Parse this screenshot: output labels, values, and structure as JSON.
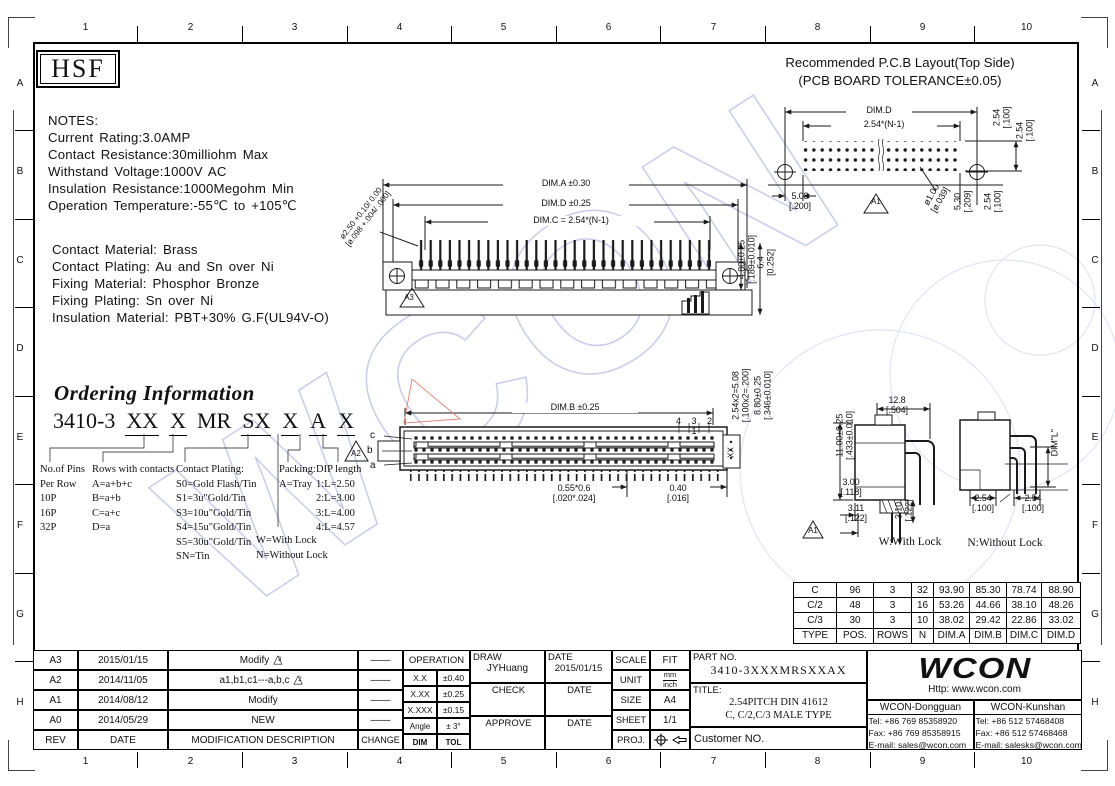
{
  "frame": {
    "cols": [
      "1",
      "2",
      "3",
      "4",
      "5",
      "6",
      "7",
      "8",
      "9",
      "10"
    ],
    "rows": [
      "A",
      "B",
      "C",
      "D",
      "E",
      "F",
      "G",
      "H"
    ]
  },
  "logo_text": "HSF",
  "watermark_text": "WCON",
  "icons": {
    "revision_triangle": "△"
  },
  "notes": {
    "heading": "NOTES:",
    "block1": "Current Rating:3.0AMP\nContact Resistance:30milliohm Max\nWithstand Voltage:1000V AC\nInsulation Resistance:1000Megohm Min\nOperation Temperature:-55℃ to +105℃",
    "block2": "Contact Material: Brass\nContact Plating: Au and Sn over Ni\nFixing Material: Phosphor Bronze\nFixing Plating: Sn over Ni\nInsulation Material: PBT+30% G.F(UL94V-O)"
  },
  "pcb": {
    "title1": "Recommended P.C.B Layout(Top Side)",
    "title2": "(PCB BOARD TOLERANCE±0.05)",
    "dim_d": "DIM.D",
    "span": "2.54*(N-1)",
    "row_pitch1": "2.54\n[.100]",
    "row_pitch2": "2.54\n[.100]",
    "offset": "5.08\n[.200]",
    "datum": "A1",
    "hole": "ø1.00\n[ø.039]",
    "edge": "5.30\n[.209]",
    "pitch": "2.54\n[.100]"
  },
  "side": {
    "dim_a": "DIM.A ±0.30",
    "dim_d": "DIM.D ±0.25",
    "dim_c": "DIM.C = 2.54*(N-1)",
    "pin_dia": "ø2.50 +0.10/ 0.00\n[ø.098 +.004/ .000]",
    "datum": "A3",
    "height": "4.80±0.25\n[.189±0.010]",
    "height2": "6.4\n[0.252]"
  },
  "front": {
    "dim_b": "DIM.B ±0.25",
    "pin_numbers": "4 3 2 1",
    "row_c": "c",
    "row_b": "b",
    "row_a": "a",
    "datum": "A2",
    "tail": "0.55*0.6\n[.020*.024]",
    "end_gap": "0.40\n[.016]",
    "end_code": "XX",
    "vdim1": "2.54x2=5.08\n[.100x2=.200]",
    "vdim2": "8.80±0.25\n[.346±0.010]"
  },
  "wlock": {
    "height": "11.00±0.25\n[.433±0.010]",
    "width": "12.8\n[.504]",
    "d1": "3.00\n[.118]",
    "d2": "3.11\n[.122]",
    "d3": "3.10\n[.122]",
    "datum": "A1",
    "caption": "W:With Lock"
  },
  "nlock": {
    "dim_l": "DIM\"L\"",
    "p1": "2.54\n[.100]",
    "p2": "2.54\n[.100]",
    "caption": "N:Without Lock"
  },
  "ordering": {
    "title": "Ordering Information",
    "code_parts": [
      "3410-3",
      "XX",
      "X",
      "MR",
      "SX",
      "X",
      "A",
      "X"
    ],
    "col_pins": "No.of Pins\nPer Row\n10P\n16P\n32P",
    "col_rows": "Rows with contacts\nA=a+b+c\nB=a+b\nC=a+c\nD=a",
    "col_plating": "Contact Plating:\nS0=Gold Flash/Tin\nS1=3u\"Gold/Tin\nS3=10u\"Gold/Tin\nS4=15u\"Gold/Tin\nS5=30u\"Gold/Tin\nSN=Tin",
    "col_packing": "Packing:\nA=Tray",
    "col_dip": "DIP length\n1:L=2.50\n2:L=3.00\n3:L=4.00\n4:L=4.57",
    "col_lock": "W=With Lock\nN=Without Lock"
  },
  "spec_table": {
    "rows": [
      [
        "C",
        "96",
        "3",
        "32",
        "93.90",
        "85.30",
        "78.74",
        "88.90"
      ],
      [
        "C/2",
        "48",
        "3",
        "16",
        "53.26",
        "44.66",
        "38.10",
        "48.26"
      ],
      [
        "C/3",
        "30",
        "3",
        "10",
        "38.02",
        "29.42",
        "22.86",
        "33.02"
      ],
      [
        "TYPE",
        "POS.",
        "ROWS",
        "N",
        "DIM.A",
        "DIM.B",
        "DIM.C",
        "DIM.D"
      ]
    ]
  },
  "revisions": {
    "rows": [
      {
        "rev": "A3",
        "date": "2015/01/15",
        "desc": "Modify",
        "marker": "3",
        "change": "——"
      },
      {
        "rev": "A2",
        "date": "2014/11/05",
        "desc": "a1,b1,c1---a,b,c",
        "marker": "2",
        "change": "——"
      },
      {
        "rev": "A1",
        "date": "2014/08/12",
        "desc": "Modify",
        "marker": "",
        "change": "——"
      },
      {
        "rev": "A0",
        "date": "2014/05/29",
        "desc": "NEW",
        "marker": "",
        "change": "——"
      }
    ],
    "header": {
      "rev": "REV",
      "date": "DATE",
      "desc": "MODIFICATION  DESCRIPTION",
      "change": "CHANGE"
    }
  },
  "tolerance": {
    "title": "OPERATION",
    "rows": [
      [
        "X.X",
        "±0.40"
      ],
      [
        "X.XX",
        "±0.25"
      ],
      [
        "X.XXX",
        "±0.15"
      ],
      [
        "Angle",
        "± 3°"
      ],
      [
        "DIM",
        "TOL"
      ]
    ]
  },
  "signoff": {
    "draw_label": "DRAW",
    "draw_name": "JYHuang",
    "date_label": "DATE",
    "draw_date": "2015/01/15",
    "check_label": "CHECK",
    "approve_label": "APPROVE"
  },
  "meta": {
    "scale_label": "SCALE",
    "scale": "FIT",
    "unit_label": "UNIT",
    "unit_top": "mm",
    "unit_bottom": "inch",
    "size_label": "SIZE",
    "size": "A4",
    "sheet_label": "SHEET",
    "sheet": "1/1",
    "proj_label": "PROJ."
  },
  "part": {
    "no_label": "PART NO.",
    "no": "3410-3XXXMRSXXAX",
    "title_label": "TITLE:",
    "title1": "2.54PITCH DIN 41612",
    "title2": "C, C/2,C/3 MALE TYPE",
    "customer": "Customer NO."
  },
  "company": {
    "logo": "WCON",
    "url": "Http: www.wcon.com",
    "offices": [
      {
        "name": "WCON-Dongguan",
        "tel": "Tel: +86 769 85358920",
        "fax": "Fax: +86 769 85358915",
        "email": "E-mail: sales@wcon.com"
      },
      {
        "name": "WCON-Kunshan",
        "tel": "Tel: +86 512 57468408",
        "fax": "Fax: +86 512 57468468",
        "email": "E-mail: salesks@wcon.com"
      }
    ]
  }
}
